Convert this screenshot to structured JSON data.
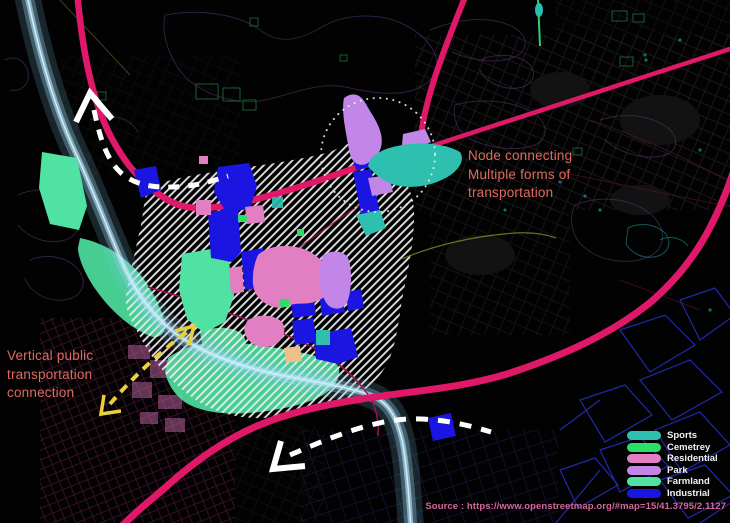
{
  "legend": {
    "items": [
      {
        "label": "Sports",
        "color": "#2fbfae"
      },
      {
        "label": "Cemetrey",
        "color": "#2cdd68"
      },
      {
        "label": "Residential",
        "color": "#e27fc2"
      },
      {
        "label": "Park",
        "color": "#c186e8"
      },
      {
        "label": "Farmland",
        "color": "#4fe2a2"
      },
      {
        "label": "Industrial",
        "color": "#1b15e2"
      }
    ]
  },
  "annotations": {
    "color": "#df6b5f",
    "node": {
      "text": "Node connecting\nMultiple forms of\ntransportation"
    },
    "vertical": {
      "text": "Vertical public\ntransportation\nconnection"
    }
  },
  "source": {
    "text": "Source : https://www.openstreetmap.org/#map=15/41.3795/2.1127",
    "color": "#d4679c"
  },
  "colors": {
    "road": "#e0186a",
    "road_minor": "#a11050",
    "river_core": "#cfeef8",
    "hatch": "#f0f0f0",
    "arrow_white": "#ffffff",
    "arrow_yellow": "#e8d23c",
    "circle": "#ededed",
    "beige_zone": "#ecc089"
  }
}
